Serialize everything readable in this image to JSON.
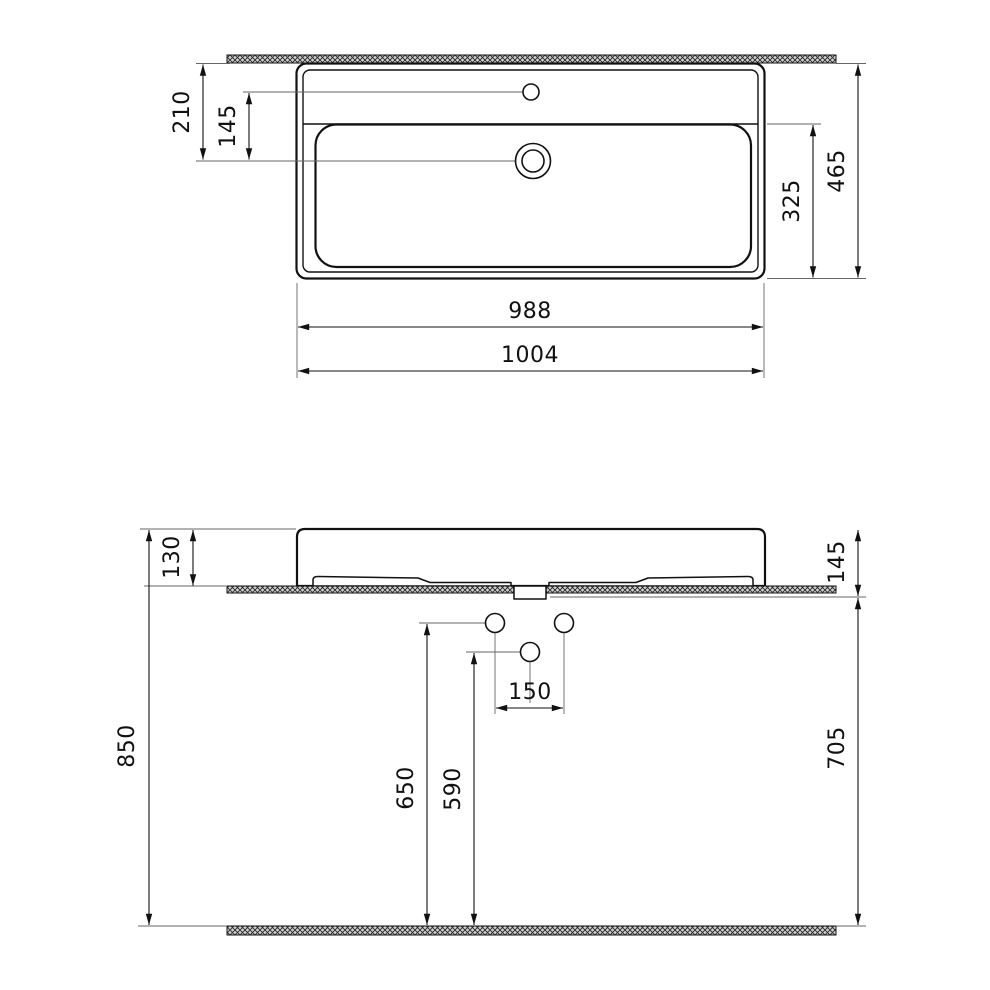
{
  "drawing": {
    "type": "technical-dimension-drawing",
    "background_color": "#ffffff",
    "object_line_color": "#111111",
    "extension_line_color": "#666666",
    "hatch_fill_color": "#cfcfcf",
    "top_view": {
      "label_wall_to_drain": "210",
      "label_faucet_to_drain": "145",
      "label_basin_depth": "325",
      "label_overall_depth": "465",
      "label_inner_width": "988",
      "label_overall_width": "1004"
    },
    "front_view": {
      "label_rim_to_shelf": "130",
      "label_rim_to_bracket": "145",
      "label_floor_to_rim": "850",
      "label_floor_to_bracket": "705",
      "label_floor_to_upper_holes": "650",
      "label_floor_to_lower_hole": "590",
      "label_hole_spacing": "150"
    }
  }
}
